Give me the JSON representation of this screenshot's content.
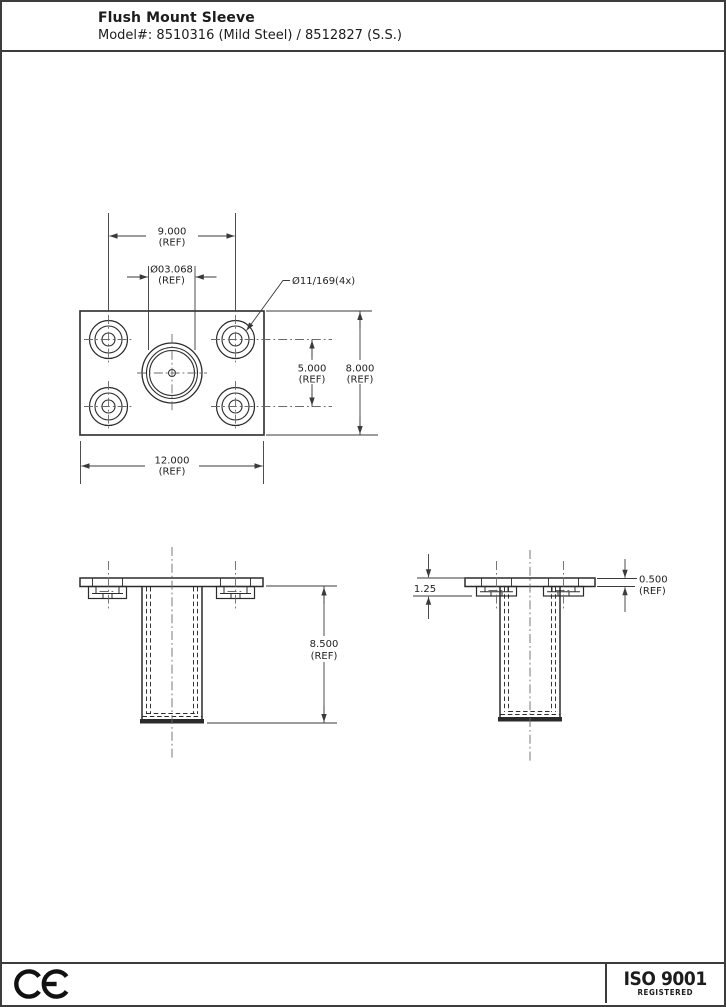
{
  "header": {
    "title": "Flush Mount Sleeve",
    "model": "Model#: 8510316 (Mild Steel) / 8512827 (S.S.)"
  },
  "drawing": {
    "top_view": {
      "dim_hole_span": {
        "value": "9.000",
        "ref": "(REF)"
      },
      "dim_bore": {
        "value": "Ø03.068",
        "ref": "(REF)"
      },
      "hole_callout": "Ø11/169(4x)",
      "dim_hole_spacing": {
        "value": "5.000",
        "ref": "(REF)"
      },
      "dim_plate_height": {
        "value": "8.000",
        "ref": "(REF)"
      },
      "dim_plate_width": {
        "value": "12.000",
        "ref": "(REF)"
      }
    },
    "front_view": {
      "dim_sleeve_length": {
        "value": "8.500",
        "ref": "(REF)"
      }
    },
    "side_view": {
      "dim_flange_depth": "1.25",
      "dim_flange_thickness": {
        "value": "0.500",
        "ref": "(REF)"
      }
    }
  },
  "footer": {
    "ce_label": "CE",
    "iso_line1": "ISO 9001",
    "iso_line2": "REGISTERED"
  },
  "colors": {
    "line": "#2b2b2b",
    "border": "#3c3c3c",
    "centerline": "#6a6a6a"
  }
}
